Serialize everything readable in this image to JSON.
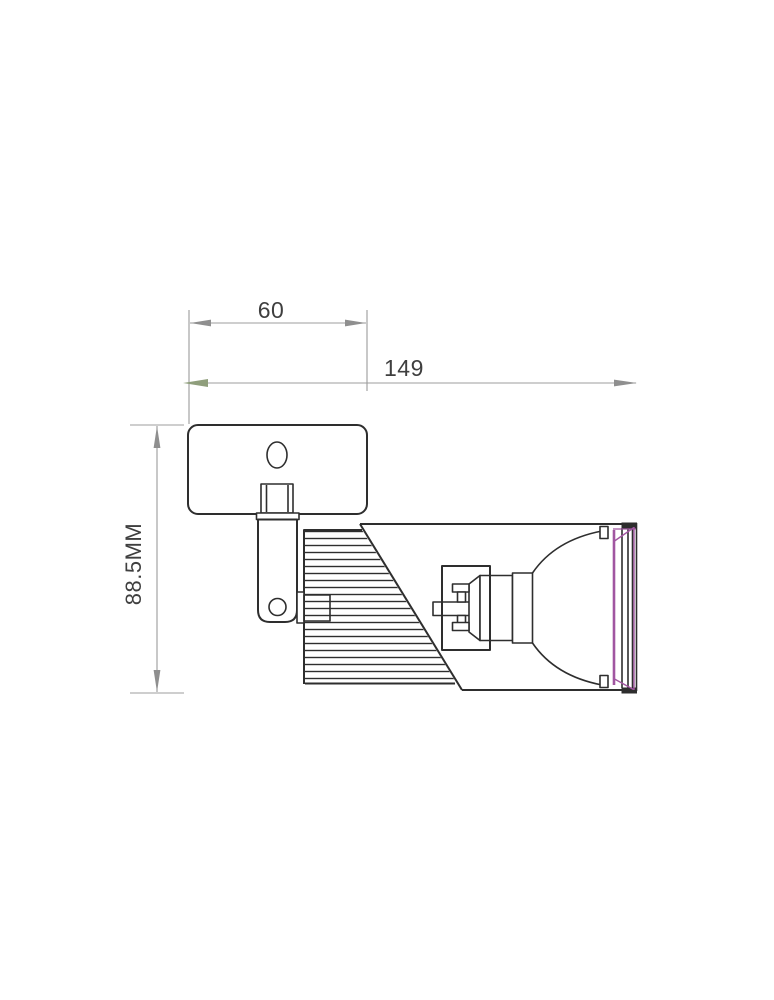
{
  "page": {
    "background": "#ffffff",
    "type_note": "technical dimension drawing of a wall/ceiling spotlight fixture, side view"
  },
  "dimensions": {
    "plate_width": {
      "value": "60"
    },
    "overall_length": {
      "value": "149"
    },
    "overall_height": {
      "value": "88.5MM"
    }
  },
  "colors": {
    "line": "#2e2e2e",
    "dim": "#9c9c9c",
    "arrow": "#8f8f8f",
    "arrow_green": "#8f9e7c",
    "glass": "#a156a1",
    "text": "#3f3f3f"
  }
}
